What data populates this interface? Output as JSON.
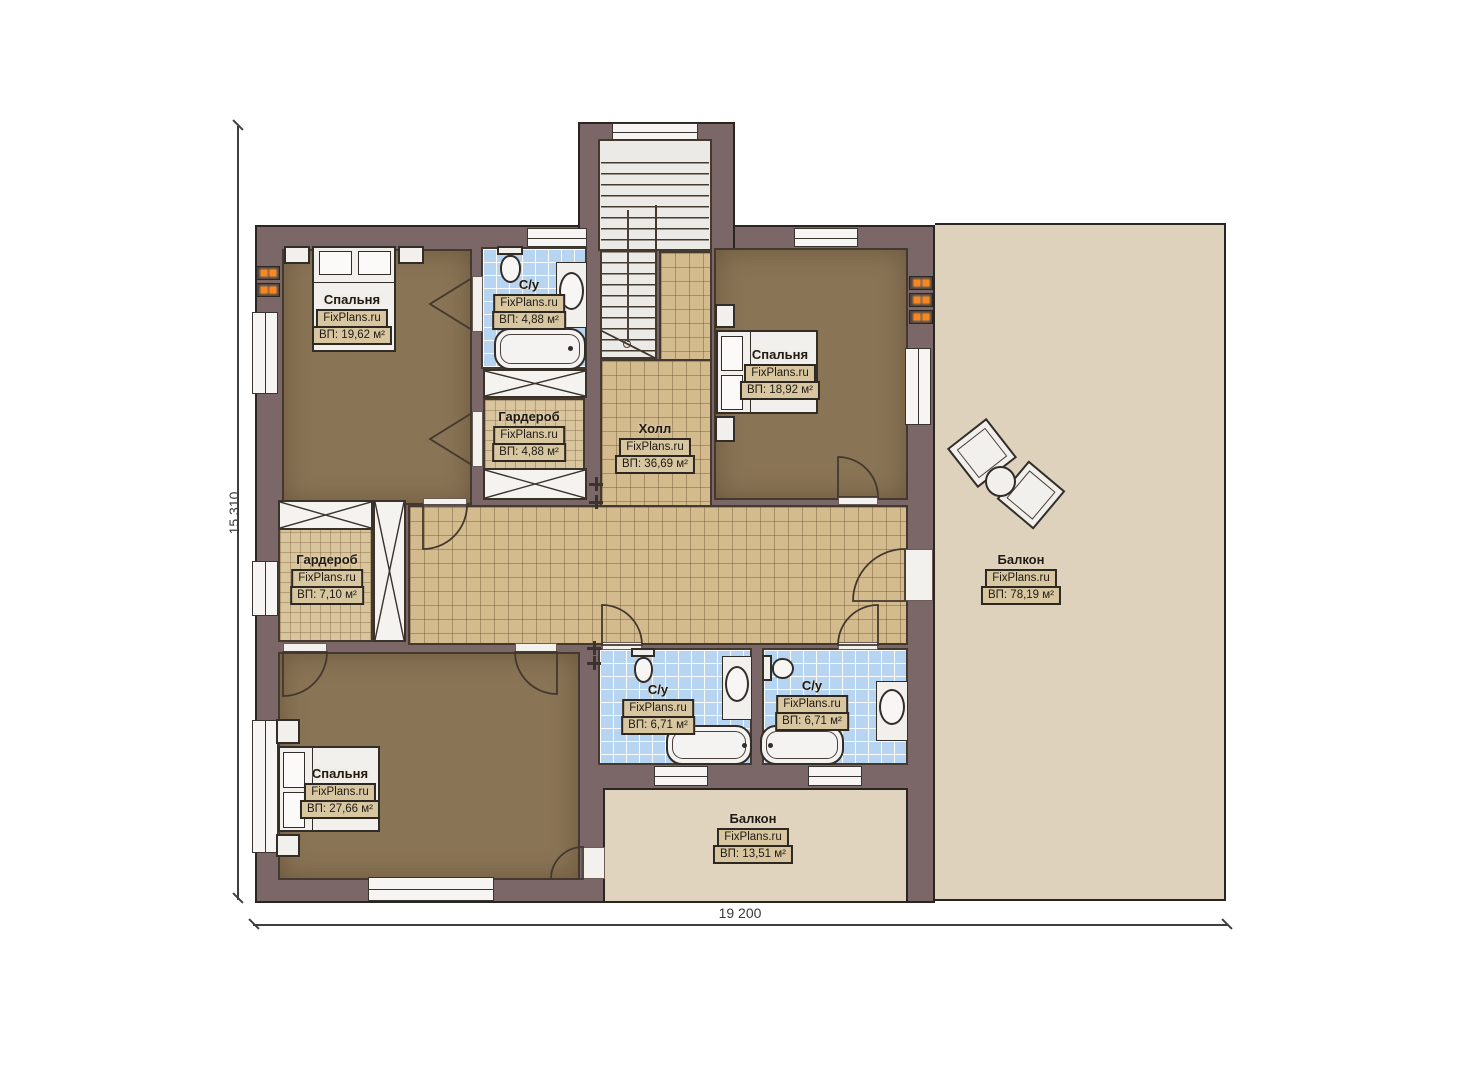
{
  "branding": "FixPlans.ru",
  "dimensions": {
    "height_label": "15 310",
    "width_label": "19 200"
  },
  "rooms": [
    {
      "key": "bedroom-top-left",
      "name": "Спальня",
      "area": "ВП: 19,62 м²"
    },
    {
      "key": "bathroom-top",
      "name": "С/у",
      "area": "ВП: 4,88 м²"
    },
    {
      "key": "wardrobe-top",
      "name": "Гардероб",
      "area": "ВП: 4,88 м²"
    },
    {
      "key": "hall",
      "name": "Холл",
      "area": "ВП: 36,69 м²"
    },
    {
      "key": "bedroom-top-right",
      "name": "Спальня",
      "area": "ВП: 18,92 м²"
    },
    {
      "key": "balcony-right",
      "name": "Балкон",
      "area": "ВП: 78,19 м²"
    },
    {
      "key": "wardrobe-left",
      "name": "Гардероб",
      "area": "ВП: 7,10 м²"
    },
    {
      "key": "bedroom-bottom-left",
      "name": "Спальня",
      "area": "ВП: 27,66 м²"
    },
    {
      "key": "bathroom-bottom-left",
      "name": "С/у",
      "area": "ВП: 6,71 м²"
    },
    {
      "key": "bathroom-bottom-right",
      "name": "С/у",
      "area": "ВП: 6,71 м²"
    },
    {
      "key": "balcony-bottom",
      "name": "Балкон",
      "area": "ВП: 13,51 м²"
    }
  ],
  "colors": {
    "wall": "#7b6668",
    "bedroom_floor": "#8a7456",
    "hall_tile": "#d3bb8e",
    "wardrobe_tile": "#d9c59d",
    "bath_tile": "#b7d4f1",
    "balcony_floor": "#ded2bd",
    "fixture_white": "#f2f0ed",
    "radiator_accent": "#f9871e",
    "outline": "#2b2521"
  }
}
